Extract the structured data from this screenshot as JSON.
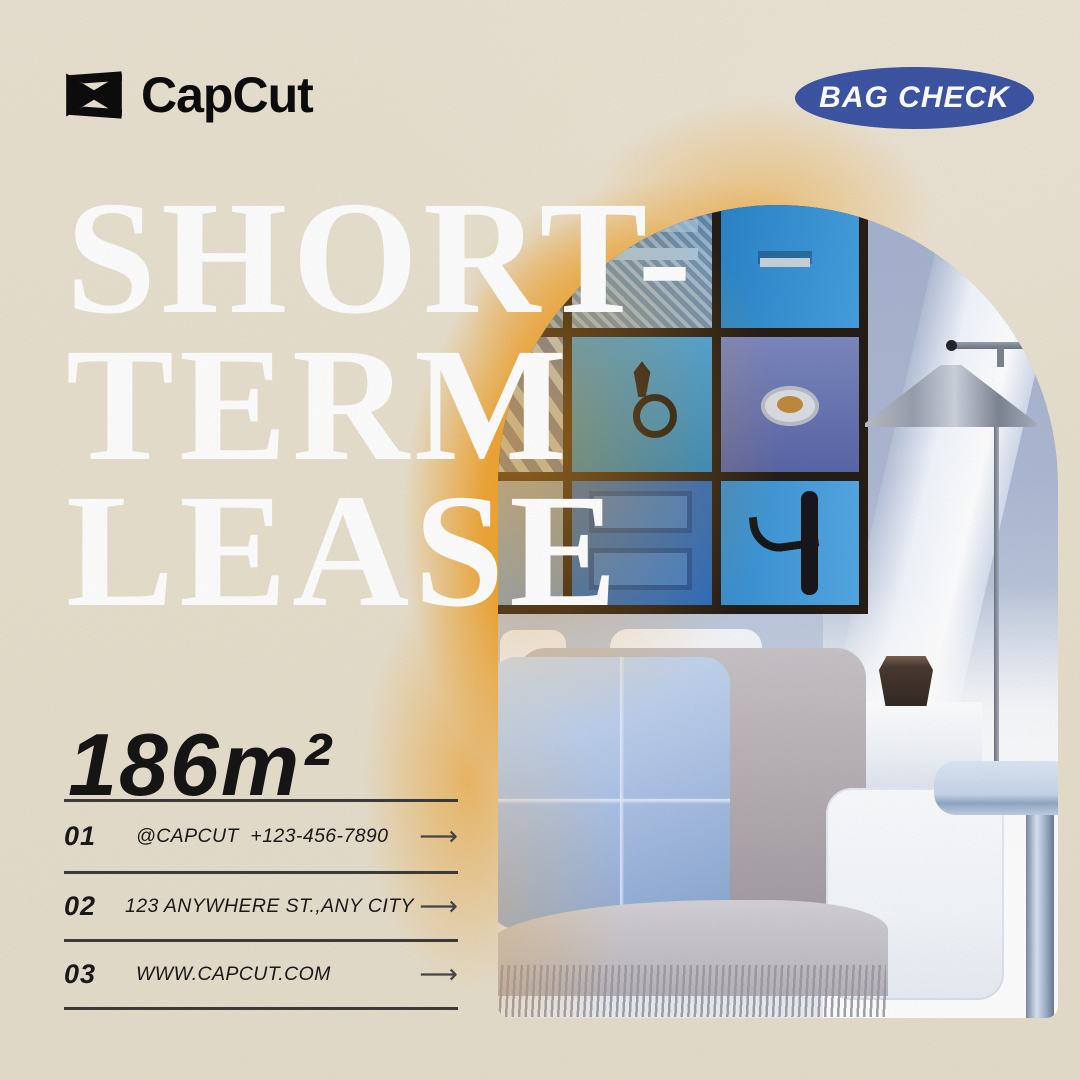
{
  "brand": {
    "name": "CapCut",
    "icon": "capcut-logo-icon"
  },
  "badge": {
    "label": "BAG CHECK"
  },
  "headline": {
    "line1": "SHORT-",
    "line2": "TERM",
    "line3": "LEASE"
  },
  "area_label": "186m²",
  "contacts": {
    "arrow": "⟶",
    "items": [
      {
        "no": "01",
        "text": "@CAPCUT  +123-456-7890"
      },
      {
        "no": "02",
        "text": "123 ANYWHERE ST.,ANY CITY"
      },
      {
        "no": "03",
        "text": "WWW.CAPCUT.COM"
      }
    ]
  },
  "photo": {
    "description": "arched living-room photo: gallery wall of blue doors, floor lamp, white sofa with blue pillows and fringed throw"
  },
  "colors": {
    "background_beige": "#e9e1cf",
    "accent_orange": "#f0a02a",
    "badge_blue": "#3d56a4",
    "headline_white": "#ffffff",
    "text_dark": "#1a1a1a",
    "wall_blue": "#adb9d3",
    "door_blue": "#2f8ed6",
    "frame_dark": "#261e17"
  }
}
